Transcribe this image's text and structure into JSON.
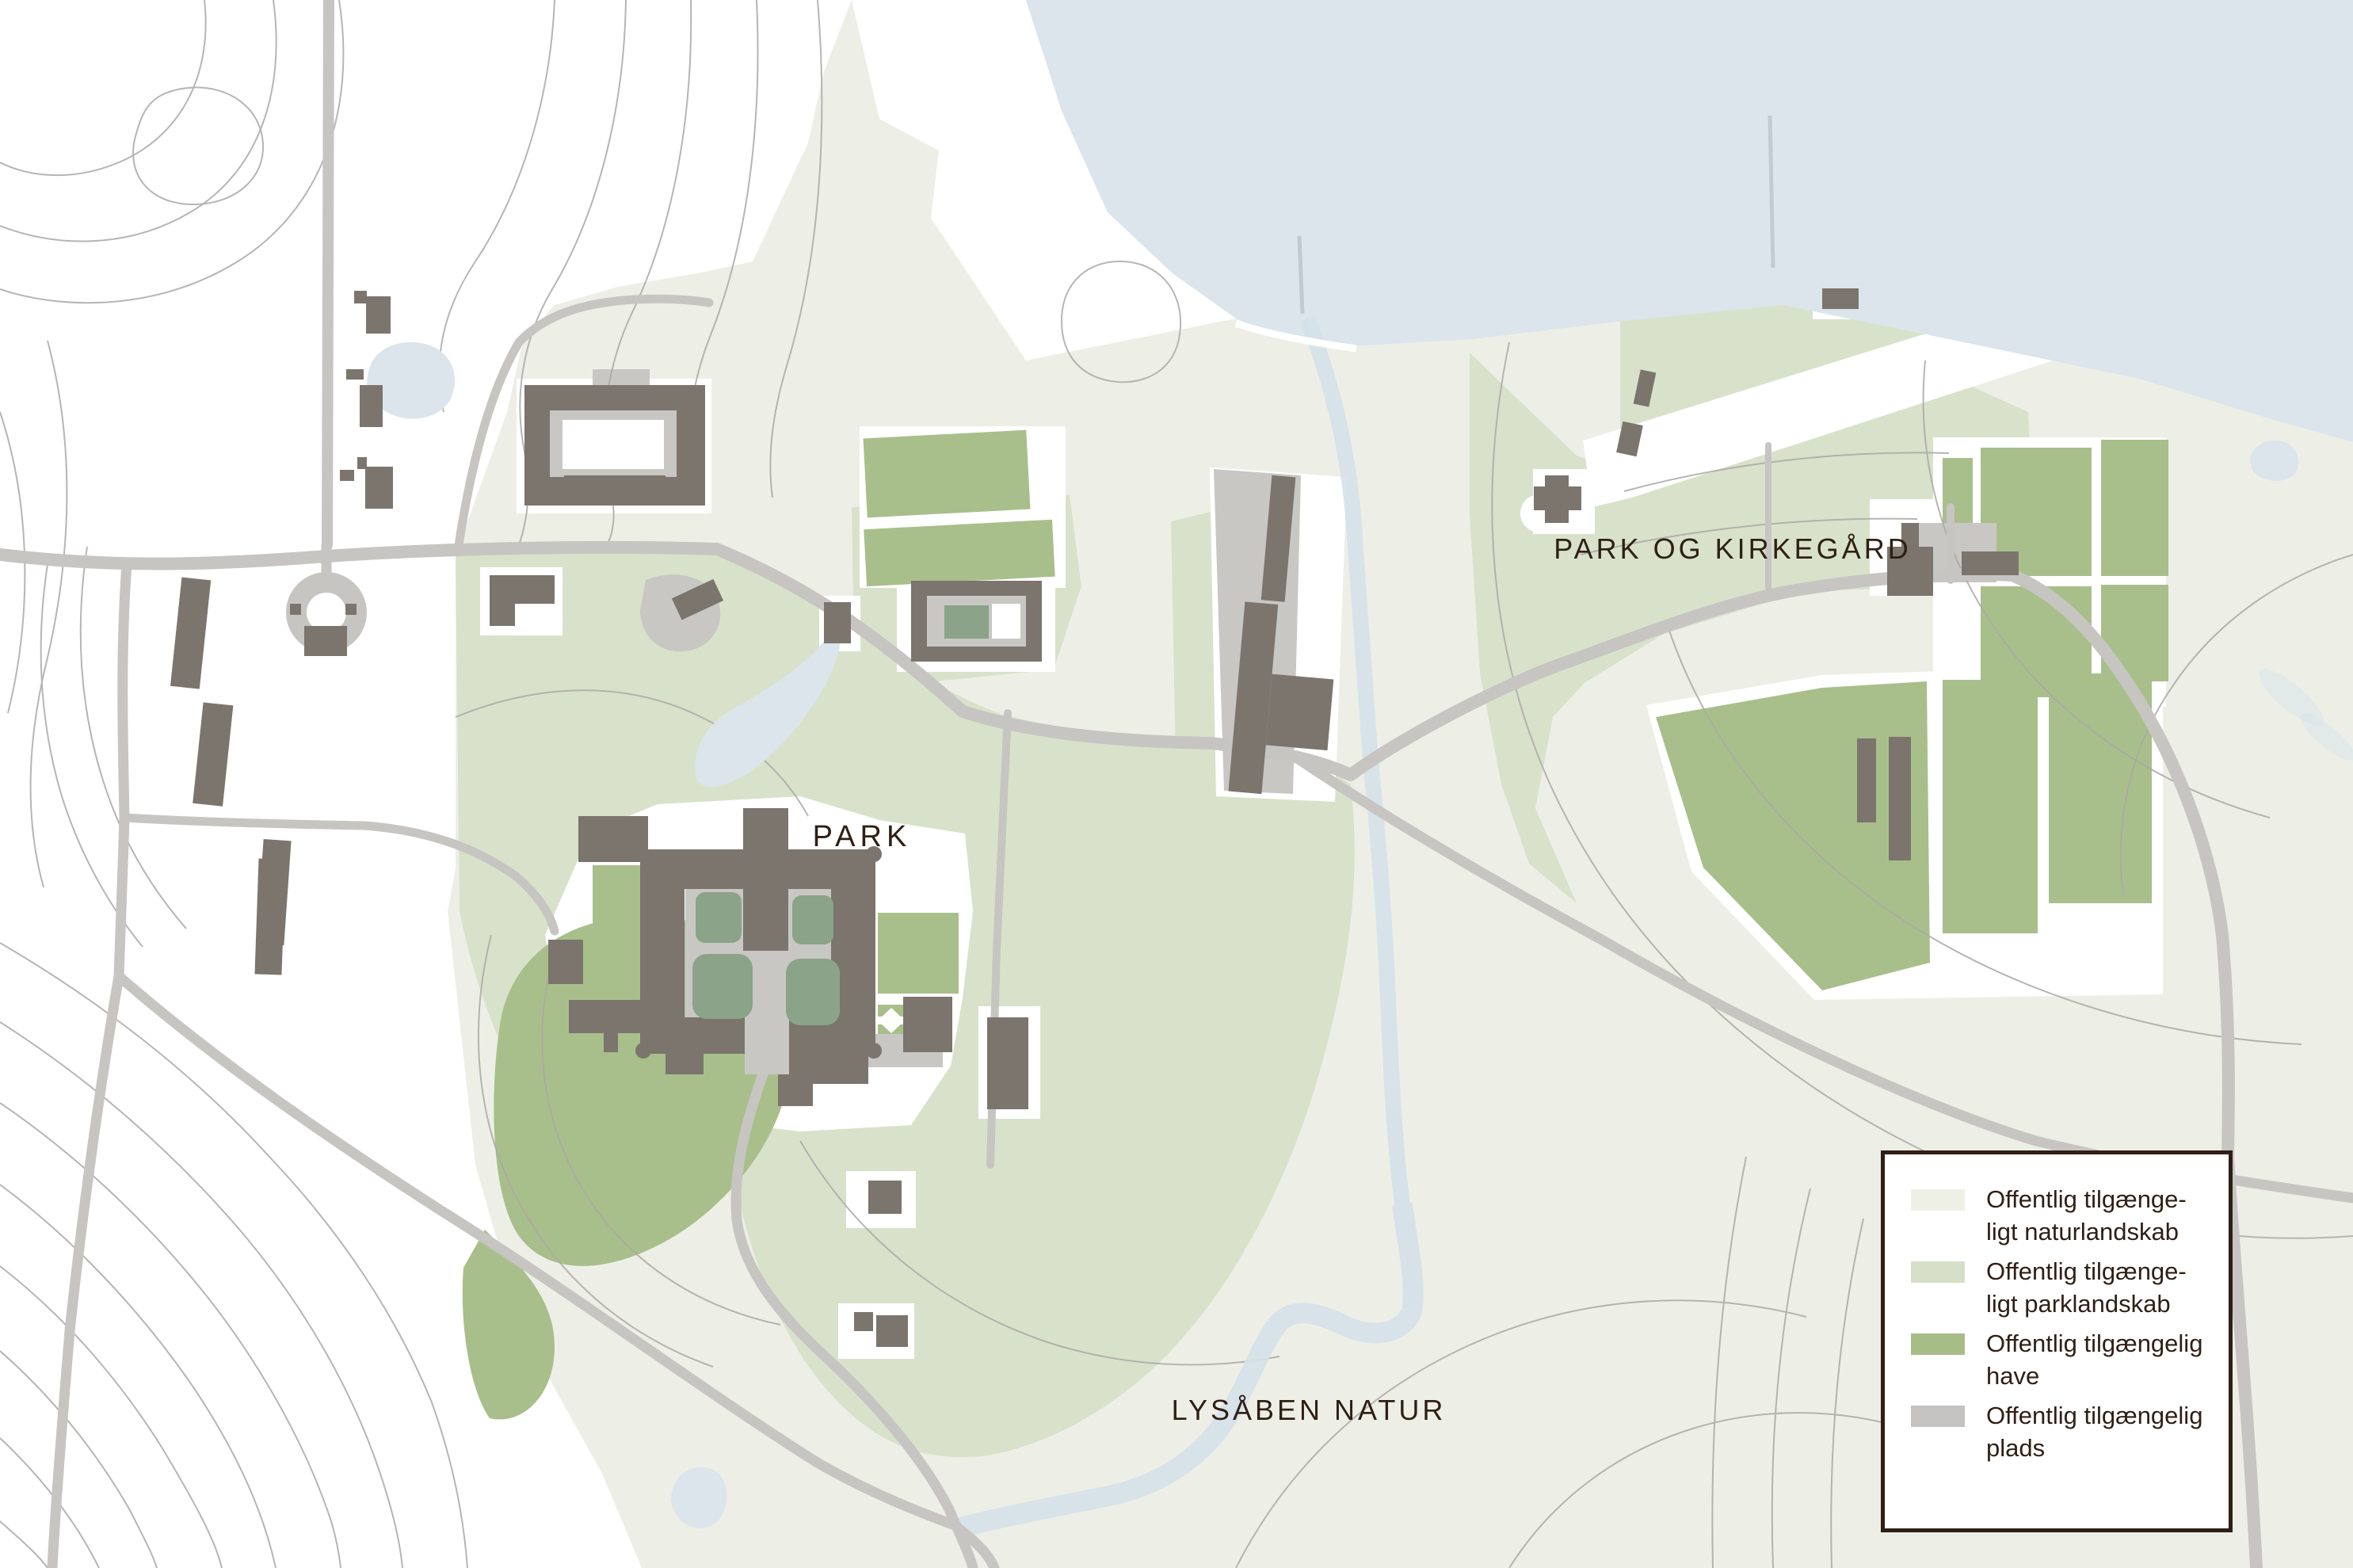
{
  "map": {
    "labels": {
      "park": "PARK",
      "park_og_kirkegaard": "PARK OG KIRKEGÅRD",
      "lysaaben_natur": "LYSÅBEN NATUR"
    }
  },
  "legend": {
    "items": [
      {
        "id": "naturlandskab",
        "color": "#eef0e8",
        "line1": "Offentlig tilgænge-",
        "line2": "ligt naturlandskab"
      },
      {
        "id": "parklandskab",
        "color": "#d6e0c8",
        "line1": "Offentlig tilgænge-",
        "line2": "ligt parklandskab"
      },
      {
        "id": "have",
        "color": "#a6bd87",
        "line1": "Offentlig tilgængelig",
        "line2": "have"
      },
      {
        "id": "plads",
        "color": "#c4c3c1",
        "line1": "Offentlig tilgængelig",
        "line2": "plads"
      }
    ]
  },
  "colors": {
    "background": "#ffffff",
    "water": "#dbe5eb",
    "stream": "#d5e1e9",
    "naturlandskab": "#edefe7",
    "parklandskab": "#d8e2cb",
    "have": "#a8bf8b",
    "plads": "#c9c7c4",
    "courtyard_garden": "#8ba388",
    "building": "#7b756d",
    "road": "#c7c5c1",
    "contour": "#aba9a6",
    "label_text": "#2f1f15",
    "legend_border": "#2f1f15"
  }
}
